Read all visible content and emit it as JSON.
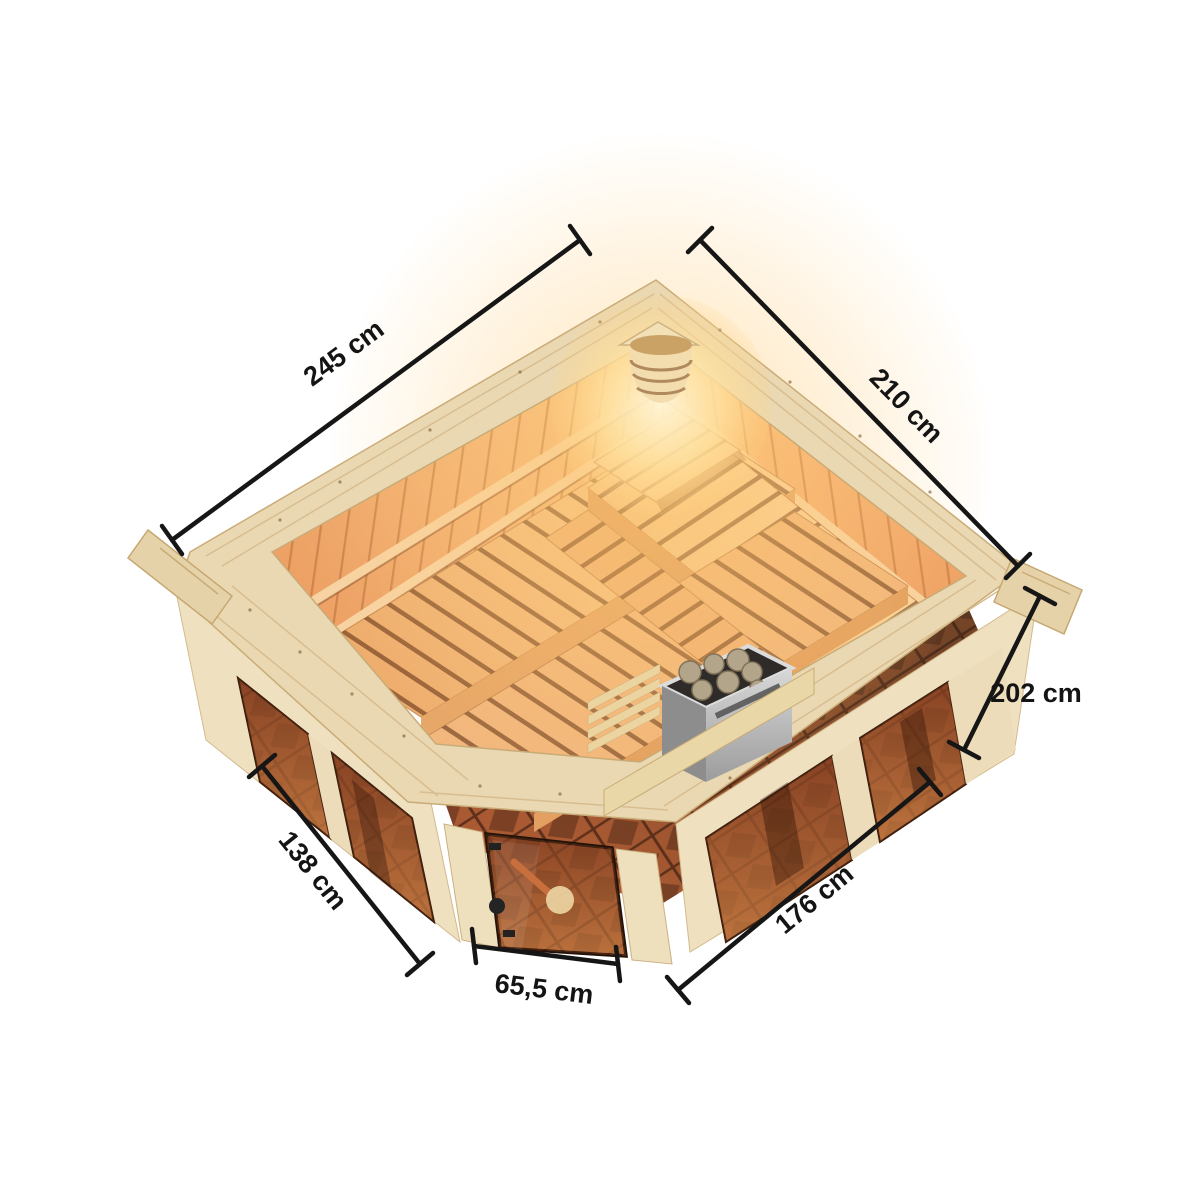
{
  "figure": {
    "background": "#ffffff",
    "kind": "isometric dimension diagram",
    "subject": "Corner sauna, bird's-eye view with interior benches, corner lamp, sauna heater and bronze glass front"
  },
  "dimensions": [
    {
      "id": "back-left-wall",
      "label": "245 cm",
      "value": 245,
      "unit": "cm",
      "position": "top-left"
    },
    {
      "id": "back-right-wall",
      "label": "210 cm",
      "value": 210,
      "unit": "cm",
      "position": "top-right"
    },
    {
      "id": "wall-height",
      "label": "202 cm",
      "value": 202,
      "unit": "cm",
      "position": "right"
    },
    {
      "id": "front-right-wall",
      "label": "176 cm",
      "value": 176,
      "unit": "cm",
      "position": "bottom-right"
    },
    {
      "id": "front-left-wall",
      "label": "138 cm",
      "value": 138,
      "unit": "cm",
      "position": "left"
    },
    {
      "id": "door-width",
      "label": "65,5 cm",
      "value": 65.5,
      "unit": "cm",
      "position": "bottom-center"
    }
  ],
  "scene": {
    "elements": [
      "back-left wall",
      "back-right wall",
      "front glass wall",
      "corner glass door",
      "L-shaped two-tier benches",
      "head rest",
      "sauna heater with stones",
      "heater guard rail",
      "corner lamp",
      "tiled floor"
    ],
    "door_handle": "black knob",
    "glass_tint": "bronze"
  },
  "colors": {
    "dimension_line": "#161616",
    "label_text": "#141414",
    "wood_rim": "#ead8b2",
    "wood_face": "#efe0c0",
    "interior_wall_warm": "#f3ab6d",
    "bench_wood": "#f3bb82",
    "glow": "#ffd080",
    "glass_bronze": "#a05527",
    "floor_tile": "#aa5a32",
    "heater_metal": "#c6c6c6",
    "stones": "#b3a58a"
  }
}
